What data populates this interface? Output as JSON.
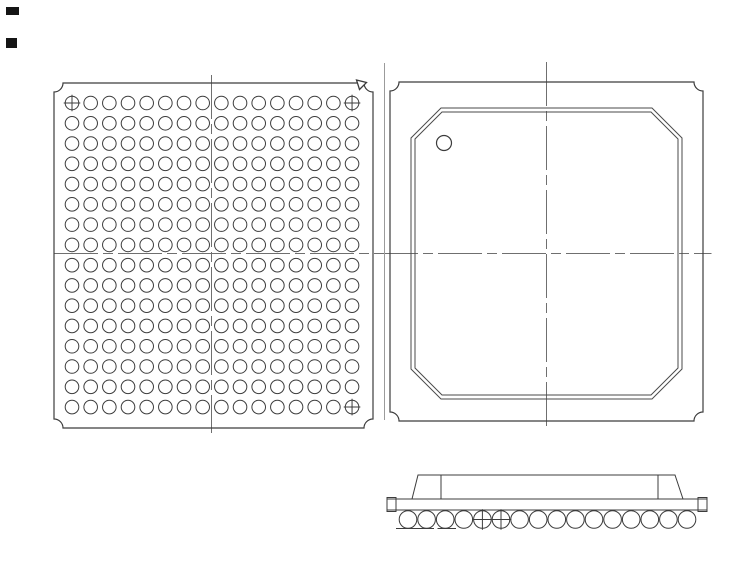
{
  "canvas": {
    "width": 754,
    "height": 576
  },
  "colors": {
    "background": "#ffffff",
    "line": "#3c3c3c",
    "lid_line": "#4a4a4a",
    "centerline": "#6f6f6f",
    "projection_line": "#9b9b9b",
    "artifact": "#151515"
  },
  "centerline_dash": "44 5 10 5",
  "shared_horizontal_centerline": {
    "y": 253.5,
    "x1": 54,
    "x2": 711.5
  },
  "views": {
    "bottom_view": {
      "outline": {
        "x": 54,
        "y": 83,
        "width": 319,
        "height": 345,
        "corner_fillet": 9
      },
      "ball_grid": {
        "columns": 16,
        "rows": 16,
        "first_center_x": 72,
        "first_center_y": 103,
        "pitch_x": 18.67,
        "pitch_y": 20.27,
        "ball_radius": 6.8
      },
      "a1_corner_crosshair_balls": [
        {
          "col": 0,
          "row": 0
        },
        {
          "col": 15,
          "row": 0
        },
        {
          "col": 15,
          "row": 15
        }
      ],
      "corner_triangle_marker_points": [
        [
          356.5,
          80
        ],
        [
          366.5,
          82.5
        ],
        [
          359.5,
          89.5
        ]
      ],
      "vertical_centerline": {
        "x": 211.5,
        "y1": 75,
        "y2": 433
      }
    },
    "top_view": {
      "outline": {
        "x": 390,
        "y": 82,
        "width": 313,
        "height": 339,
        "corner_fillet": 9
      },
      "lid_outer": {
        "x1": 411,
        "y1": 108,
        "x2": 682,
        "y2": 399,
        "chamfer": 30
      },
      "lid_inner": {
        "x1": 415,
        "y1": 112,
        "x2": 678,
        "y2": 395,
        "chamfer": 27
      },
      "pin1_circle": {
        "cx": 444,
        "cy": 143,
        "r": 7.5
      },
      "vertical_centerline": {
        "x": 546.5,
        "y1": 62,
        "y2": 426
      },
      "projection_line": {
        "x": 384.5,
        "y1": 63,
        "y2": 420
      }
    },
    "side_view": {
      "substrate": {
        "x": 387,
        "y": 499,
        "width": 320,
        "height": 11,
        "cap_width": 9,
        "cap_overhang": 1.5
      },
      "mold": {
        "base_x1": 412,
        "base_x2": 683,
        "top_x1": 418,
        "top_x2": 675,
        "top_y": 475,
        "base_y": 499,
        "inner_line_x": [
          441,
          658
        ]
      },
      "balls": {
        "count": 16,
        "first_center_x": 408,
        "pitch": 18.6,
        "center_y": 519.5,
        "radius": 8.8,
        "crosshair_indexes": [
          4,
          5
        ]
      },
      "seating_lines": [
        [
          396,
          528.5,
          434
        ],
        [
          437.5,
          528.5,
          456
        ]
      ]
    }
  },
  "scan_artifacts": [
    {
      "x": 6,
      "y": 7,
      "width": 13,
      "height": 8
    },
    {
      "x": 6,
      "y": 38,
      "width": 11,
      "height": 10
    }
  ]
}
